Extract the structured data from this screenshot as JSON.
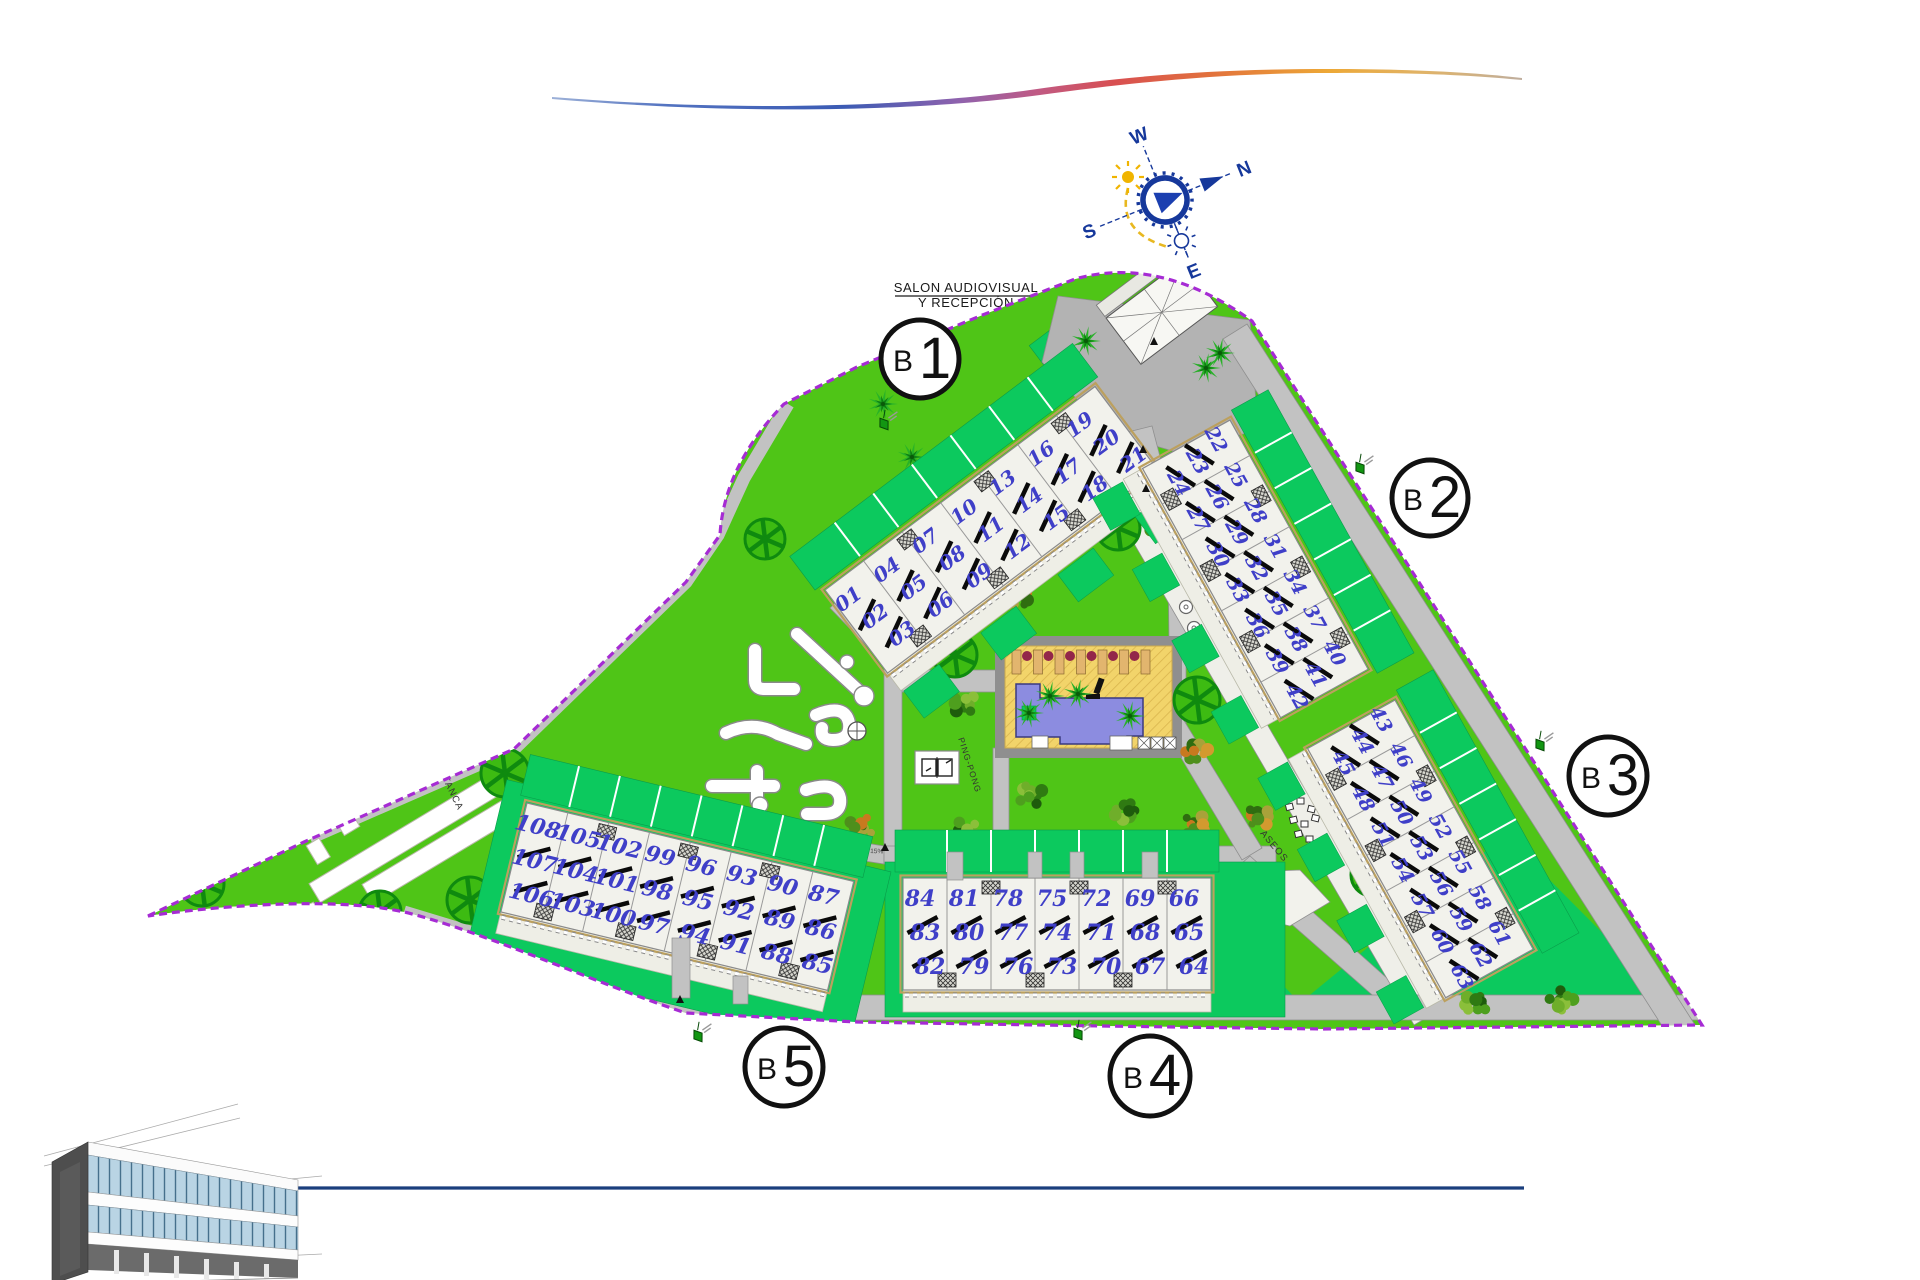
{
  "annotation": {
    "line1": "SALON AUDIOVISUAL",
    "line2": "Y RECEPCIÓN"
  },
  "compass": {
    "north": "N",
    "south": "S",
    "east": "E",
    "west": "W"
  },
  "blocks": [
    {
      "id": "B1",
      "letter": "B",
      "digit": "1",
      "units": [
        [
          "01",
          "02",
          "03"
        ],
        [
          "04",
          "05",
          "06"
        ],
        [
          "07",
          "08",
          "09"
        ],
        [
          "10",
          "11",
          "12"
        ],
        [
          "13",
          "14",
          "15"
        ],
        [
          "16",
          "17",
          "18"
        ],
        [
          "19",
          "20",
          "21"
        ]
      ]
    },
    {
      "id": "B2",
      "letter": "B",
      "digit": "2",
      "units": [
        [
          "22",
          "23",
          "24"
        ],
        [
          "25",
          "26",
          "27"
        ],
        [
          "28",
          "29",
          "30"
        ],
        [
          "31",
          "32",
          "33"
        ],
        [
          "34",
          "35",
          "36"
        ],
        [
          "37",
          "38",
          "39"
        ],
        [
          "40",
          "41",
          "42"
        ]
      ]
    },
    {
      "id": "B3",
      "letter": "B",
      "digit": "3",
      "units": [
        [
          "43",
          "44",
          "45"
        ],
        [
          "46",
          "47",
          "48"
        ],
        [
          "49",
          "50",
          "51"
        ],
        [
          "52",
          "53",
          "54"
        ],
        [
          "55",
          "56",
          "57"
        ],
        [
          "58",
          "59",
          "60"
        ],
        [
          "61",
          "62",
          "63"
        ]
      ]
    },
    {
      "id": "B4",
      "letter": "B",
      "digit": "4",
      "units": [
        [
          "84",
          "83",
          "82"
        ],
        [
          "81",
          "80",
          "79"
        ],
        [
          "78",
          "77",
          "76"
        ],
        [
          "75",
          "74",
          "73"
        ],
        [
          "72",
          "71",
          "70"
        ],
        [
          "69",
          "68",
          "67"
        ],
        [
          "66",
          "65",
          "64"
        ]
      ]
    },
    {
      "id": "B5",
      "letter": "B",
      "digit": "5",
      "units": [
        [
          "108",
          "107",
          "106"
        ],
        [
          "105",
          "104",
          "103"
        ],
        [
          "102",
          "101",
          "100"
        ],
        [
          "99",
          "98",
          "97"
        ],
        [
          "96",
          "95",
          "94"
        ],
        [
          "93",
          "92",
          "91"
        ],
        [
          "90",
          "89",
          "88"
        ],
        [
          "87",
          "86",
          "85"
        ]
      ]
    }
  ],
  "amenities": {
    "petanca": "PETANCA",
    "gimnasia": "GIMNASIA",
    "pingpong": "PING-PONG",
    "children": "CHILDREN",
    "aseos": "ASEOS"
  },
  "slope_labels": [
    {
      "text": "Pte. 10%"
    },
    {
      "text": "Pte. 10%"
    },
    {
      "text": "Pte. 15%"
    },
    {
      "text": "Pte. 10%"
    },
    {
      "text": "Pte. 10%"
    },
    {
      "text": "Pte. 15%"
    },
    {
      "text": "Pte. 10%"
    },
    {
      "text": "Pte. 15%"
    }
  ],
  "colors": {
    "lawn": "#4fc517",
    "garden": "#0cc95e",
    "path": "#c2c2c2",
    "plaza": "#b3b3b3",
    "boundary": "#a62bd4",
    "unit_number": "#3f3fc8",
    "building_fill": "#f2f2ec",
    "pool_water": "#8c8ce0",
    "pool_deck": "#f2d46a",
    "tree": "#0f8a0f",
    "compass_blue": "#16389b",
    "sun_yellow": "#f0b400",
    "swoosh_blue": "#3b5bb4",
    "swoosh_pink": "#c05a84",
    "swoosh_orange": "#eda836",
    "footer_line": "#1b3f7d"
  }
}
